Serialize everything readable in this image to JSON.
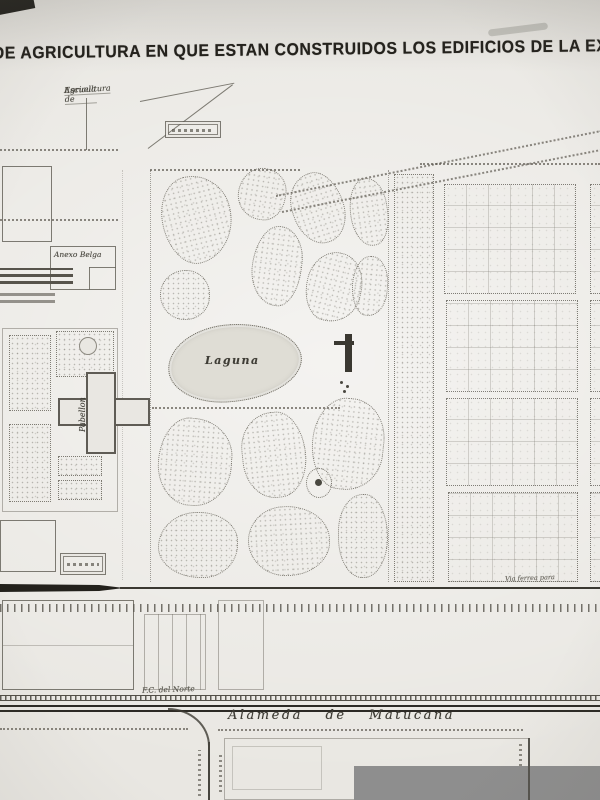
{
  "document": {
    "title": "AL DE AGRICULTURA EN QUE ESTAN CONSTRUIDOS LOS EDIFICIOS DE LA EXPO",
    "labels": {
      "escuela_line1": "Escuela de",
      "escuela_line2": "Agricultura",
      "anexo_belga": "Anexo Belga",
      "pabellon": "Pabellon",
      "laguna": "Laguna",
      "via_ferrea": "Via ferrea para",
      "fc_del_norte": "F.C. del Norte",
      "alameda": "Alameda de Matucana"
    },
    "colors": {
      "paper": "#e9e7e2",
      "ink": "#26251f",
      "line": "#6f6c64",
      "watermark": "#8e8e8e"
    }
  }
}
